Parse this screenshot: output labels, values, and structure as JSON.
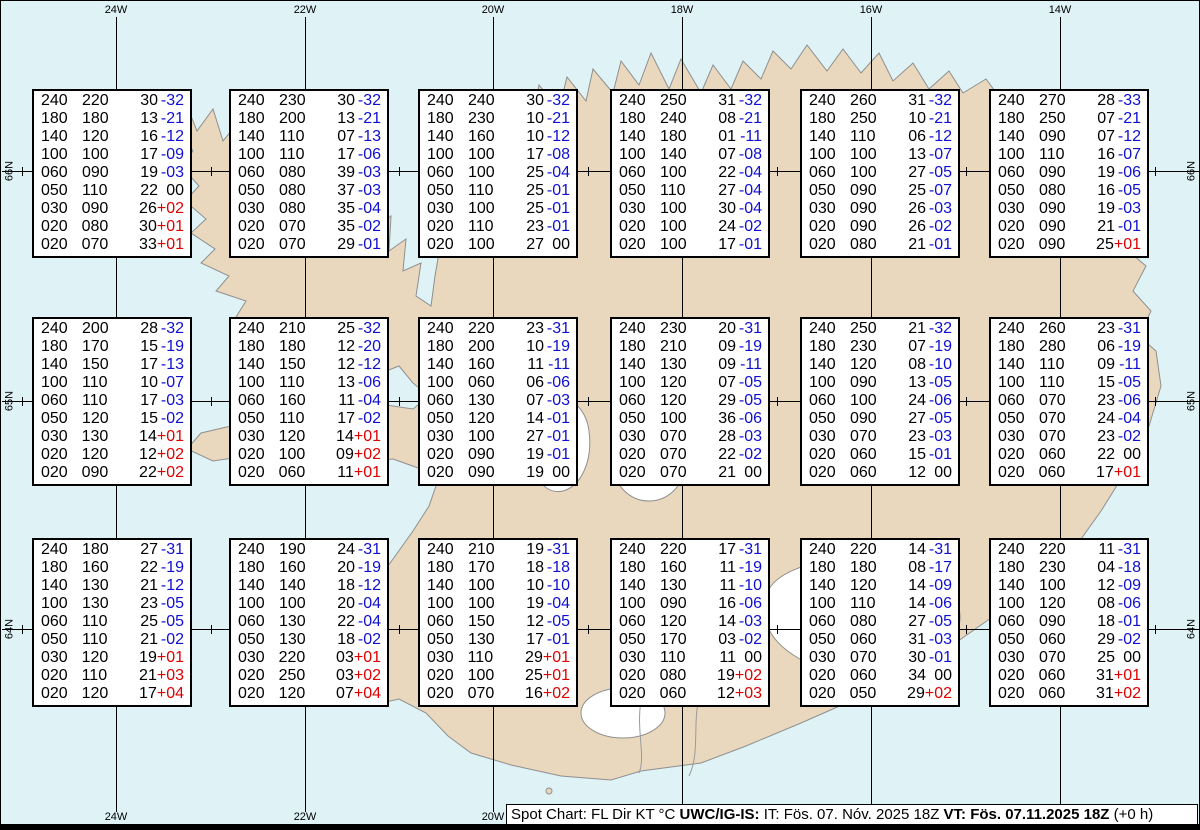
{
  "colors": {
    "sea": "#dff3f7",
    "land": "#e9d8bd",
    "coast": "#8f8f8f",
    "grid": "#000000",
    "box_bg": "#ffffff",
    "box_border": "#000000",
    "text": "#000000",
    "temp_negative": "#0f0fd0",
    "temp_positive": "#dd0000",
    "glacier": "#ffffff"
  },
  "map": {
    "meridian_labels_top": [
      "24W",
      "22W",
      "20W",
      "18W",
      "16W",
      "14W"
    ],
    "meridian_labels_bottom": [
      "24W",
      "22W",
      "20W"
    ],
    "parallel_labels": [
      "66N",
      "65N",
      "64N"
    ]
  },
  "footer": {
    "prefix": "Spot Chart: FL Dir KT °C ",
    "source": "UWC/IG-IS:",
    "issue": " IT: Fös. 07. Nóv. 2025 18Z ",
    "valid": "VT: Fös. 07.11.2025 18Z",
    "suffix": " (+0 h)"
  },
  "chart_data": {
    "type": "table",
    "title": "Spot Chart: FL Dir KT °C",
    "columns": [
      "FL",
      "Dir",
      "KT",
      "TempC"
    ],
    "spots": [
      {
        "row": 0,
        "col": 0,
        "values": [
          [
            "240",
            "220",
            "30",
            "-32"
          ],
          [
            "180",
            "180",
            "13",
            "-21"
          ],
          [
            "140",
            "120",
            "16",
            "-12"
          ],
          [
            "100",
            "100",
            "17",
            "-09"
          ],
          [
            "060",
            "090",
            "19",
            "-03"
          ],
          [
            "050",
            "110",
            "22",
            "00"
          ],
          [
            "030",
            "090",
            "26",
            "+02"
          ],
          [
            "020",
            "080",
            "30",
            "+01"
          ],
          [
            "020",
            "070",
            "33",
            "+01"
          ]
        ]
      },
      {
        "row": 0,
        "col": 1,
        "values": [
          [
            "240",
            "230",
            "30",
            "-32"
          ],
          [
            "180",
            "200",
            "13",
            "-21"
          ],
          [
            "140",
            "110",
            "07",
            "-13"
          ],
          [
            "100",
            "110",
            "17",
            "-06"
          ],
          [
            "060",
            "080",
            "39",
            "-03"
          ],
          [
            "050",
            "080",
            "37",
            "-03"
          ],
          [
            "030",
            "080",
            "35",
            "-04"
          ],
          [
            "020",
            "070",
            "35",
            "-02"
          ],
          [
            "020",
            "070",
            "29",
            "-01"
          ]
        ]
      },
      {
        "row": 0,
        "col": 2,
        "values": [
          [
            "240",
            "240",
            "30",
            "-32"
          ],
          [
            "180",
            "230",
            "10",
            "-21"
          ],
          [
            "140",
            "160",
            "10",
            "-12"
          ],
          [
            "100",
            "100",
            "17",
            "-08"
          ],
          [
            "060",
            "100",
            "25",
            "-04"
          ],
          [
            "050",
            "110",
            "25",
            "-01"
          ],
          [
            "030",
            "100",
            "25",
            "-01"
          ],
          [
            "020",
            "110",
            "23",
            "-01"
          ],
          [
            "020",
            "100",
            "27",
            "00"
          ]
        ]
      },
      {
        "row": 0,
        "col": 3,
        "values": [
          [
            "240",
            "250",
            "31",
            "-32"
          ],
          [
            "180",
            "240",
            "08",
            "-21"
          ],
          [
            "140",
            "180",
            "01",
            "-11"
          ],
          [
            "100",
            "140",
            "07",
            "-08"
          ],
          [
            "060",
            "100",
            "22",
            "-04"
          ],
          [
            "050",
            "110",
            "27",
            "-04"
          ],
          [
            "030",
            "100",
            "30",
            "-04"
          ],
          [
            "020",
            "100",
            "24",
            "-02"
          ],
          [
            "020",
            "100",
            "17",
            "-01"
          ]
        ]
      },
      {
        "row": 0,
        "col": 4,
        "values": [
          [
            "240",
            "260",
            "31",
            "-32"
          ],
          [
            "180",
            "250",
            "10",
            "-21"
          ],
          [
            "140",
            "110",
            "06",
            "-12"
          ],
          [
            "100",
            "100",
            "13",
            "-07"
          ],
          [
            "060",
            "100",
            "27",
            "-05"
          ],
          [
            "050",
            "090",
            "25",
            "-07"
          ],
          [
            "030",
            "090",
            "26",
            "-03"
          ],
          [
            "020",
            "090",
            "26",
            "-02"
          ],
          [
            "020",
            "080",
            "21",
            "-01"
          ]
        ]
      },
      {
        "row": 0,
        "col": 5,
        "values": [
          [
            "240",
            "270",
            "28",
            "-33"
          ],
          [
            "180",
            "250",
            "07",
            "-21"
          ],
          [
            "140",
            "090",
            "07",
            "-12"
          ],
          [
            "100",
            "110",
            "16",
            "-07"
          ],
          [
            "060",
            "090",
            "19",
            "-06"
          ],
          [
            "050",
            "080",
            "16",
            "-05"
          ],
          [
            "030",
            "090",
            "19",
            "-03"
          ],
          [
            "020",
            "090",
            "21",
            "-01"
          ],
          [
            "020",
            "090",
            "25",
            "+01"
          ]
        ]
      },
      {
        "row": 1,
        "col": 0,
        "values": [
          [
            "240",
            "200",
            "28",
            "-32"
          ],
          [
            "180",
            "170",
            "15",
            "-19"
          ],
          [
            "140",
            "150",
            "17",
            "-13"
          ],
          [
            "100",
            "110",
            "10",
            "-07"
          ],
          [
            "060",
            "110",
            "17",
            "-03"
          ],
          [
            "050",
            "120",
            "15",
            "-02"
          ],
          [
            "030",
            "130",
            "14",
            "+01"
          ],
          [
            "020",
            "120",
            "12",
            "+02"
          ],
          [
            "020",
            "090",
            "22",
            "+02"
          ]
        ]
      },
      {
        "row": 1,
        "col": 1,
        "values": [
          [
            "240",
            "210",
            "25",
            "-32"
          ],
          [
            "180",
            "180",
            "12",
            "-20"
          ],
          [
            "140",
            "150",
            "12",
            "-12"
          ],
          [
            "100",
            "110",
            "13",
            "-06"
          ],
          [
            "060",
            "160",
            "11",
            "-04"
          ],
          [
            "050",
            "110",
            "17",
            "-02"
          ],
          [
            "030",
            "120",
            "14",
            "+01"
          ],
          [
            "020",
            "100",
            "09",
            "+02"
          ],
          [
            "020",
            "060",
            "11",
            "+01"
          ]
        ]
      },
      {
        "row": 1,
        "col": 2,
        "values": [
          [
            "240",
            "220",
            "23",
            "-31"
          ],
          [
            "180",
            "200",
            "10",
            "-19"
          ],
          [
            "140",
            "160",
            "11",
            "-11"
          ],
          [
            "100",
            "060",
            "06",
            "-06"
          ],
          [
            "060",
            "130",
            "07",
            "-03"
          ],
          [
            "050",
            "120",
            "14",
            "-01"
          ],
          [
            "030",
            "100",
            "27",
            "-01"
          ],
          [
            "020",
            "090",
            "19",
            "-01"
          ],
          [
            "020",
            "090",
            "19",
            "00"
          ]
        ]
      },
      {
        "row": 1,
        "col": 3,
        "values": [
          [
            "240",
            "230",
            "20",
            "-31"
          ],
          [
            "180",
            "210",
            "09",
            "-19"
          ],
          [
            "140",
            "130",
            "09",
            "-11"
          ],
          [
            "100",
            "120",
            "07",
            "-05"
          ],
          [
            "060",
            "120",
            "29",
            "-05"
          ],
          [
            "050",
            "100",
            "36",
            "-06"
          ],
          [
            "030",
            "070",
            "28",
            "-03"
          ],
          [
            "020",
            "070",
            "22",
            "-02"
          ],
          [
            "020",
            "070",
            "21",
            "00"
          ]
        ]
      },
      {
        "row": 1,
        "col": 4,
        "values": [
          [
            "240",
            "250",
            "21",
            "-32"
          ],
          [
            "180",
            "230",
            "07",
            "-19"
          ],
          [
            "140",
            "120",
            "08",
            "-10"
          ],
          [
            "100",
            "090",
            "13",
            "-05"
          ],
          [
            "060",
            "100",
            "24",
            "-06"
          ],
          [
            "050",
            "090",
            "27",
            "-05"
          ],
          [
            "030",
            "070",
            "23",
            "-03"
          ],
          [
            "020",
            "060",
            "15",
            "-01"
          ],
          [
            "020",
            "060",
            "12",
            "00"
          ]
        ]
      },
      {
        "row": 1,
        "col": 5,
        "values": [
          [
            "240",
            "260",
            "23",
            "-31"
          ],
          [
            "180",
            "280",
            "06",
            "-19"
          ],
          [
            "140",
            "110",
            "09",
            "-11"
          ],
          [
            "100",
            "110",
            "15",
            "-05"
          ],
          [
            "060",
            "070",
            "23",
            "-06"
          ],
          [
            "050",
            "070",
            "24",
            "-04"
          ],
          [
            "030",
            "070",
            "23",
            "-02"
          ],
          [
            "020",
            "060",
            "22",
            "00"
          ],
          [
            "020",
            "060",
            "17",
            "+01"
          ]
        ]
      },
      {
        "row": 2,
        "col": 0,
        "values": [
          [
            "240",
            "180",
            "27",
            "-31"
          ],
          [
            "180",
            "160",
            "22",
            "-19"
          ],
          [
            "140",
            "130",
            "21",
            "-12"
          ],
          [
            "100",
            "130",
            "23",
            "-05"
          ],
          [
            "060",
            "110",
            "25",
            "-05"
          ],
          [
            "050",
            "110",
            "21",
            "-02"
          ],
          [
            "030",
            "120",
            "19",
            "+01"
          ],
          [
            "020",
            "110",
            "21",
            "+03"
          ],
          [
            "020",
            "120",
            "17",
            "+04"
          ]
        ]
      },
      {
        "row": 2,
        "col": 1,
        "values": [
          [
            "240",
            "190",
            "24",
            "-31"
          ],
          [
            "180",
            "160",
            "20",
            "-19"
          ],
          [
            "140",
            "140",
            "18",
            "-12"
          ],
          [
            "100",
            "100",
            "20",
            "-04"
          ],
          [
            "060",
            "130",
            "22",
            "-04"
          ],
          [
            "050",
            "130",
            "18",
            "-02"
          ],
          [
            "030",
            "220",
            "03",
            "+01"
          ],
          [
            "020",
            "250",
            "03",
            "+02"
          ],
          [
            "020",
            "120",
            "07",
            "+04"
          ]
        ]
      },
      {
        "row": 2,
        "col": 2,
        "values": [
          [
            "240",
            "210",
            "19",
            "-31"
          ],
          [
            "180",
            "170",
            "18",
            "-18"
          ],
          [
            "140",
            "100",
            "10",
            "-10"
          ],
          [
            "100",
            "100",
            "19",
            "-04"
          ],
          [
            "060",
            "150",
            "12",
            "-05"
          ],
          [
            "050",
            "130",
            "17",
            "-01"
          ],
          [
            "030",
            "110",
            "29",
            "+01"
          ],
          [
            "020",
            "100",
            "25",
            "+01"
          ],
          [
            "020",
            "070",
            "16",
            "+02"
          ]
        ]
      },
      {
        "row": 2,
        "col": 3,
        "values": [
          [
            "240",
            "220",
            "17",
            "-31"
          ],
          [
            "180",
            "160",
            "11",
            "-19"
          ],
          [
            "140",
            "130",
            "11",
            "-10"
          ],
          [
            "100",
            "090",
            "16",
            "-06"
          ],
          [
            "060",
            "120",
            "14",
            "-03"
          ],
          [
            "050",
            "170",
            "03",
            "-02"
          ],
          [
            "030",
            "110",
            "11",
            "00"
          ],
          [
            "020",
            "080",
            "19",
            "+02"
          ],
          [
            "020",
            "060",
            "12",
            "+03"
          ]
        ]
      },
      {
        "row": 2,
        "col": 4,
        "values": [
          [
            "240",
            "220",
            "14",
            "-31"
          ],
          [
            "180",
            "180",
            "08",
            "-17"
          ],
          [
            "140",
            "120",
            "14",
            "-09"
          ],
          [
            "100",
            "110",
            "14",
            "-06"
          ],
          [
            "060",
            "080",
            "27",
            "-05"
          ],
          [
            "050",
            "060",
            "31",
            "-03"
          ],
          [
            "030",
            "070",
            "30",
            "-01"
          ],
          [
            "020",
            "060",
            "34",
            "00"
          ],
          [
            "020",
            "050",
            "29",
            "+02"
          ]
        ]
      },
      {
        "row": 2,
        "col": 5,
        "values": [
          [
            "240",
            "220",
            "11",
            "-31"
          ],
          [
            "180",
            "230",
            "04",
            "-18"
          ],
          [
            "140",
            "100",
            "12",
            "-09"
          ],
          [
            "100",
            "120",
            "08",
            "-06"
          ],
          [
            "060",
            "090",
            "18",
            "-01"
          ],
          [
            "050",
            "060",
            "29",
            "-02"
          ],
          [
            "030",
            "070",
            "25",
            "00"
          ],
          [
            "020",
            "060",
            "31",
            "+01"
          ],
          [
            "020",
            "060",
            "31",
            "+02"
          ]
        ]
      }
    ]
  }
}
